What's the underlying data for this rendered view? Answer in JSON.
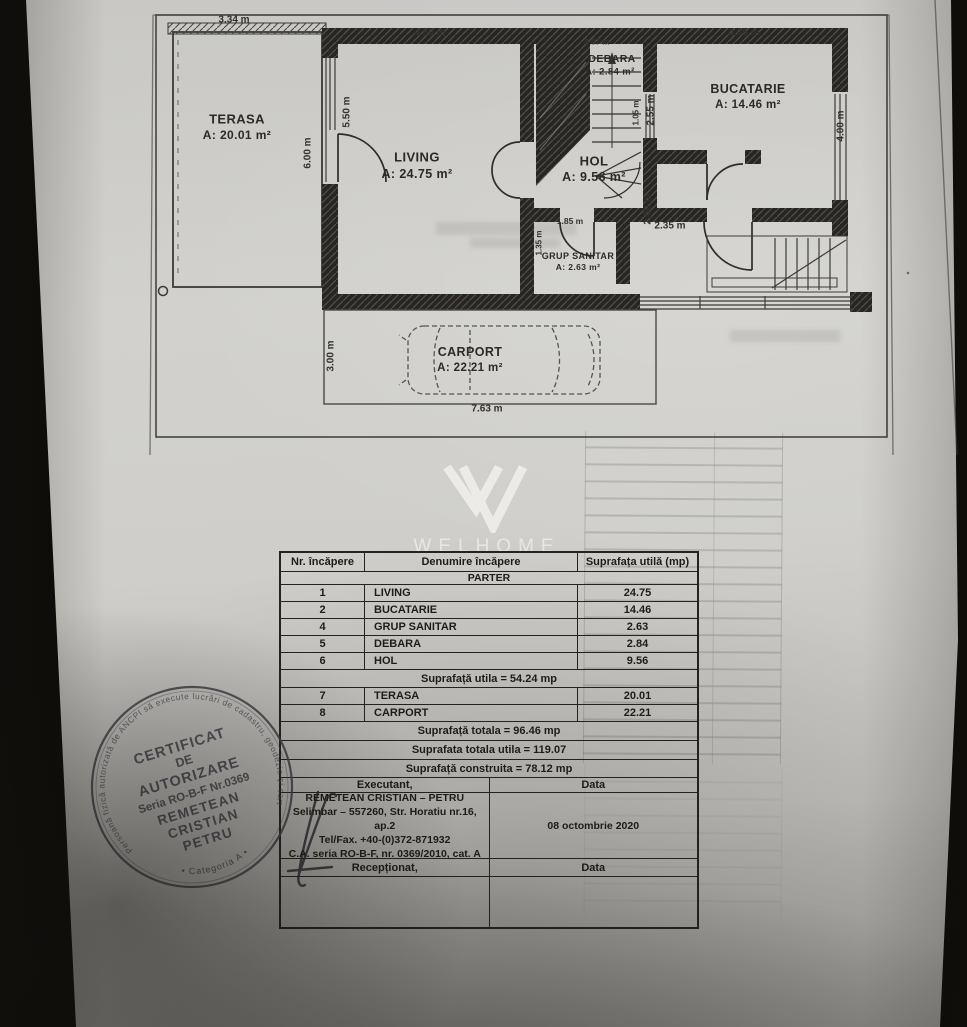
{
  "logo": {
    "brand": "WELHOME"
  },
  "plan": {
    "rooms": [
      {
        "name": "TERASA",
        "area": "A: 20.01 m²"
      },
      {
        "name": "LIVING",
        "area": "A: 24.75 m²"
      },
      {
        "name": "HOL",
        "area": "A: 9.56 m²"
      },
      {
        "name": "DEBARA",
        "area": "A: 2.84 m²"
      },
      {
        "name": "BUCATARIE",
        "area": "A: 14.46 m²"
      },
      {
        "name": "GRUP SANITAR",
        "area": "A: 2.63 m²"
      },
      {
        "name": "CARPORT",
        "area": "A: 22.21 m²"
      }
    ],
    "dims": [
      "3.34 m",
      "4.50 m",
      "0.97 m",
      "4.05 m",
      "5.50 m",
      "6.00 m",
      "2.55 m",
      "1.05 m",
      "4.00 m",
      "2.60 m",
      "2.35 m",
      "1.85 m",
      "1.35 m",
      "3.00 m",
      "7.63 m"
    ]
  },
  "table": {
    "col_headers": [
      "Nr. încăpere",
      "Denumire încăpere",
      "Suprafața utilă (mp)"
    ],
    "section": "PARTER",
    "rows": [
      {
        "nr": "1",
        "name": "LIVING",
        "area": "24.75"
      },
      {
        "nr": "2",
        "name": "BUCATARIE",
        "area": "14.46"
      },
      {
        "nr": "4",
        "name": "GRUP SANITAR",
        "area": "2.63"
      },
      {
        "nr": "5",
        "name": "DEBARA",
        "area": "2.84"
      },
      {
        "nr": "6",
        "name": "HOL",
        "area": "9.56"
      }
    ],
    "subtotal": "Suprafață utila = 54.24 mp",
    "rows2": [
      {
        "nr": "7",
        "name": "TERASA",
        "area": "20.01"
      },
      {
        "nr": "8",
        "name": "CARPORT",
        "area": "22.21"
      }
    ],
    "totals": [
      "Suprafață totala = 96.46 mp",
      "Suprafata totala utila = 119.07",
      "Suprafață construita = 78.12 mp"
    ],
    "executant_label": "Executant,",
    "data_label": "Data",
    "executant_lines": [
      "REMETEAN CRISTIAN – PETRU",
      "Selimbar – 557260, Str. Horatiu nr.16, ap.2",
      "Tel/Fax. +40-(0)372-871932",
      "C.A. seria RO-B-F, nr. 0369/2010, cat. A"
    ],
    "date": "08 octombrie 2020",
    "receptionat_label": "Recepționat,",
    "data_label2": "Data"
  },
  "stamp": {
    "ring_top": "Persoană fizică autorizată de ANCPI să execute lucrări de cadastru, geodezie și cartografie",
    "ring_bottom": "• Categoria A •",
    "lines": [
      "CERTIFICAT",
      "DE",
      "AUTORIZARE",
      "Seria RO-B-F Nr.0369",
      "REMETEAN",
      "CRISTIAN",
      "PETRU"
    ]
  },
  "colors": {
    "paper": "#d0cfcb",
    "ink": "#242320",
    "stamp_ink": "#46454d",
    "logo": "#e9e8e4"
  }
}
